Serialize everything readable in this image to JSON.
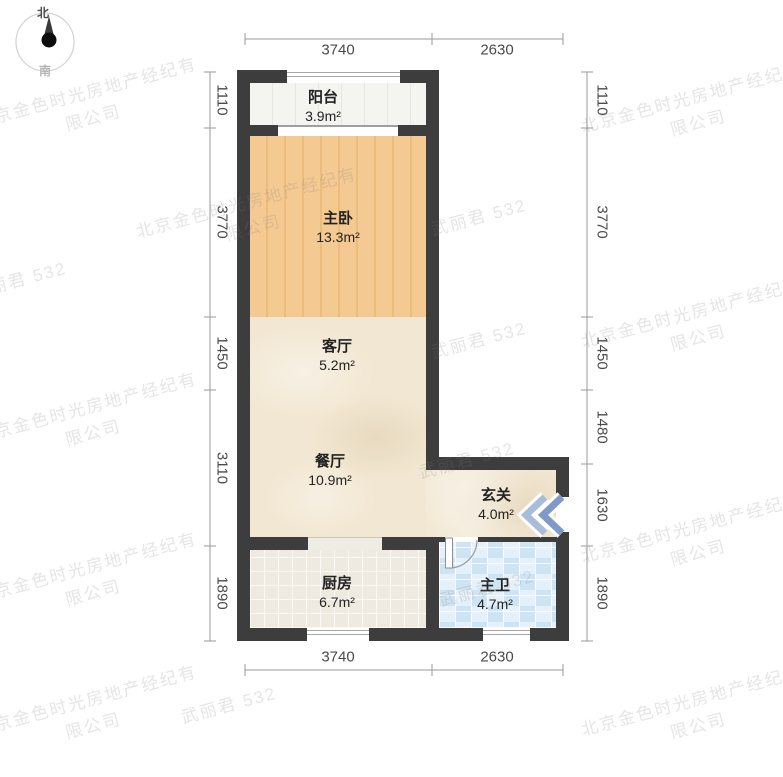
{
  "compass": {
    "north": "北",
    "south": "南"
  },
  "watermarks": {
    "company": "北京金色时光房地产经纪有\n限公司",
    "agent": "武丽君 532"
  },
  "rooms": [
    {
      "id": "balcony",
      "name": "阳台",
      "area": "3.9m²"
    },
    {
      "id": "bedroom",
      "name": "主卧",
      "area": "13.3m²"
    },
    {
      "id": "living",
      "name": "客厅",
      "area": "5.2m²"
    },
    {
      "id": "dining",
      "name": "餐厅",
      "area": "10.9m²"
    },
    {
      "id": "entry",
      "name": "玄关",
      "area": "4.0m²"
    },
    {
      "id": "kitchen",
      "name": "厨房",
      "area": "6.7m²"
    },
    {
      "id": "bath",
      "name": "主卫",
      "area": "4.7m²"
    }
  ],
  "dimensions": {
    "top": [
      "3740",
      "2630"
    ],
    "bottom": [
      "3740",
      "2630"
    ],
    "left": [
      "1110",
      "3770",
      "1450",
      "3110",
      "1890"
    ],
    "right": [
      "1110",
      "3770",
      "1450",
      "1480",
      "1630",
      "1890"
    ]
  },
  "colors": {
    "wall": "#3d3d3d",
    "wood_floor": "#f5c992",
    "beige_floor": "#f2e7d2",
    "balcony_floor": "#f4f4f1",
    "kitchen_tile": "#eeeae0",
    "bath_tile": "#d9ecf8",
    "entry_arrow": "#8ca8ce",
    "dim_text": "#4a4a4a",
    "watermark": "rgba(125,125,125,0.20)"
  }
}
